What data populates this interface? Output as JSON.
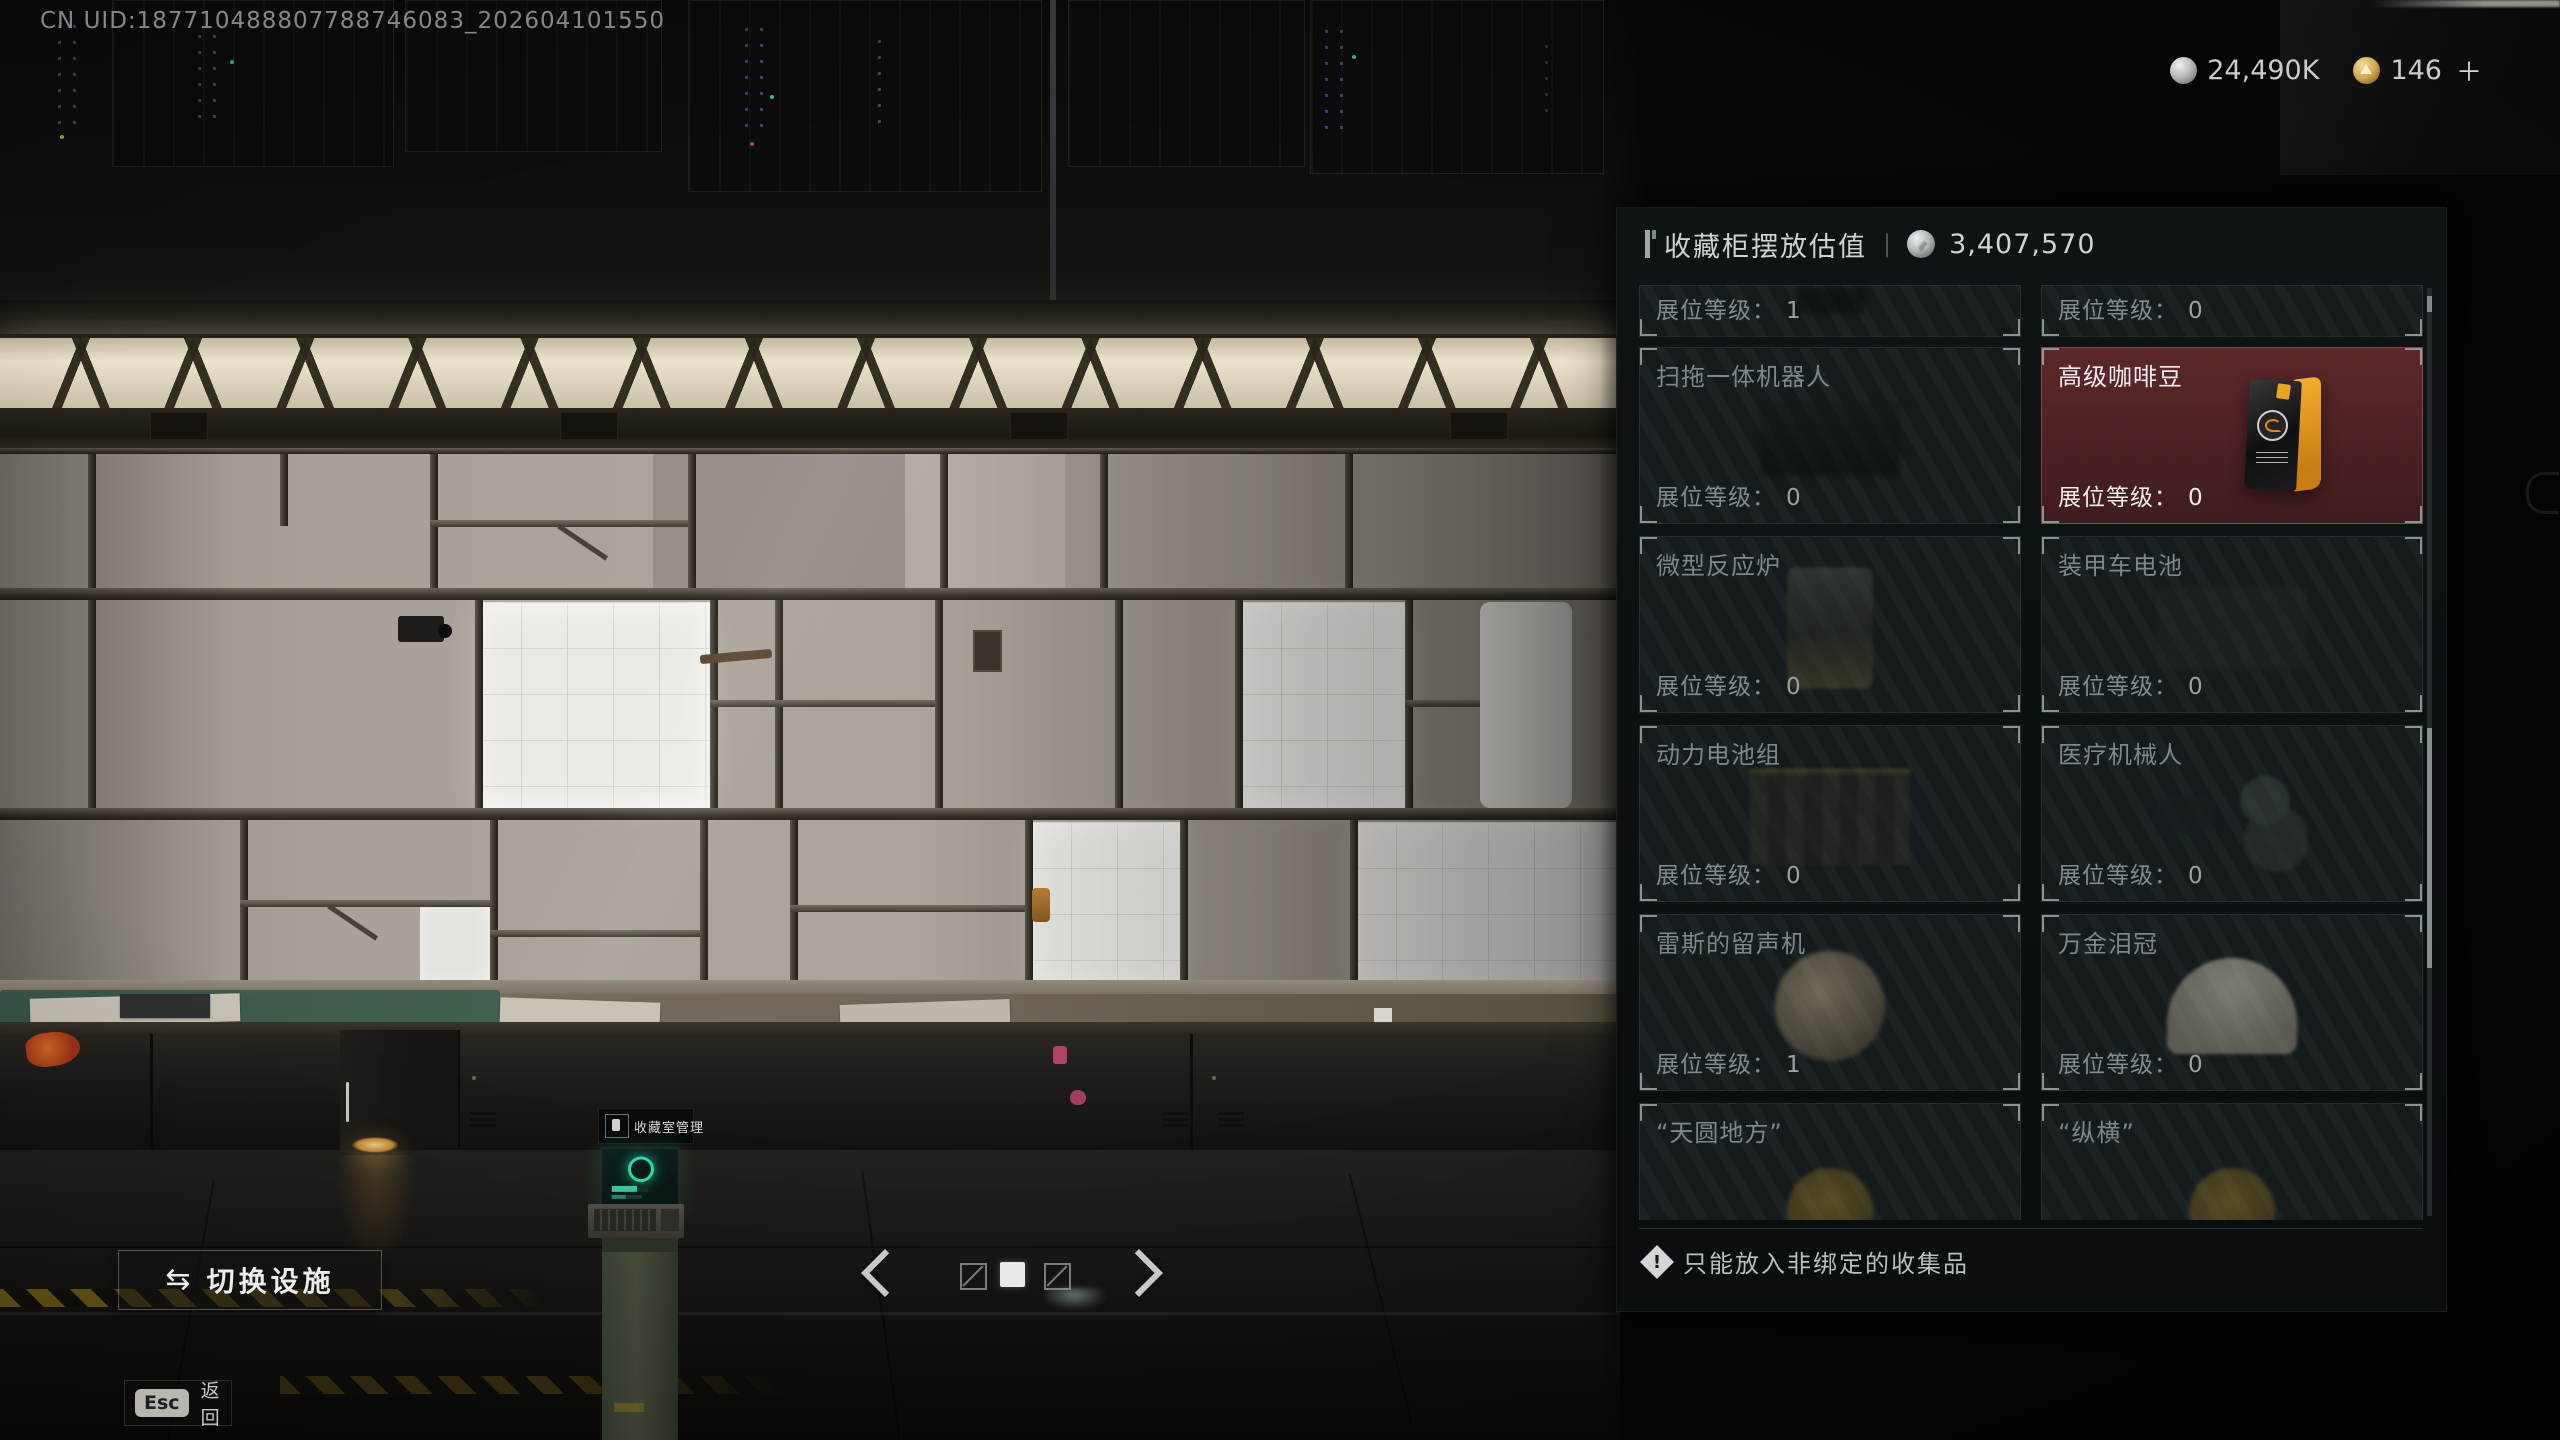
{
  "hud": {
    "uid": "CN UID:187710488807788746083_202604101550",
    "currency_silver": "24,490K",
    "currency_gold": "146",
    "currency_gold_plus": "＋"
  },
  "panel": {
    "title": "收藏柜摆放估值",
    "divider": "|",
    "value": "3,407,570",
    "level_label": "展位等级：",
    "cells": [
      {
        "name": "",
        "level": "1"
      },
      {
        "name": "",
        "level": "0"
      },
      {
        "name": "扫拖一体机器人",
        "level": "0"
      },
      {
        "name": "高级咖啡豆",
        "level": "0",
        "highlight": true
      },
      {
        "name": "微型反应炉",
        "level": "0"
      },
      {
        "name": "装甲车电池",
        "level": "0"
      },
      {
        "name": "动力电池组",
        "level": "0"
      },
      {
        "name": "医疗机械人",
        "level": "0"
      },
      {
        "name": "雷斯的留声机",
        "level": "1"
      },
      {
        "name": "万金泪冠",
        "level": "0"
      },
      {
        "name": "“天圆地方”",
        "level": ""
      },
      {
        "name": "“纵横”",
        "level": ""
      }
    ],
    "footer_note": "只能放入非绑定的收集品"
  },
  "scene": {
    "terminal_tooltip": "收藏室管理"
  },
  "controls": {
    "switch_icon": "⇆",
    "switch_facility": "切换设施",
    "esc_key": "Esc",
    "back": "返回",
    "pager": {
      "page_count": 3,
      "active_page": 2
    }
  }
}
